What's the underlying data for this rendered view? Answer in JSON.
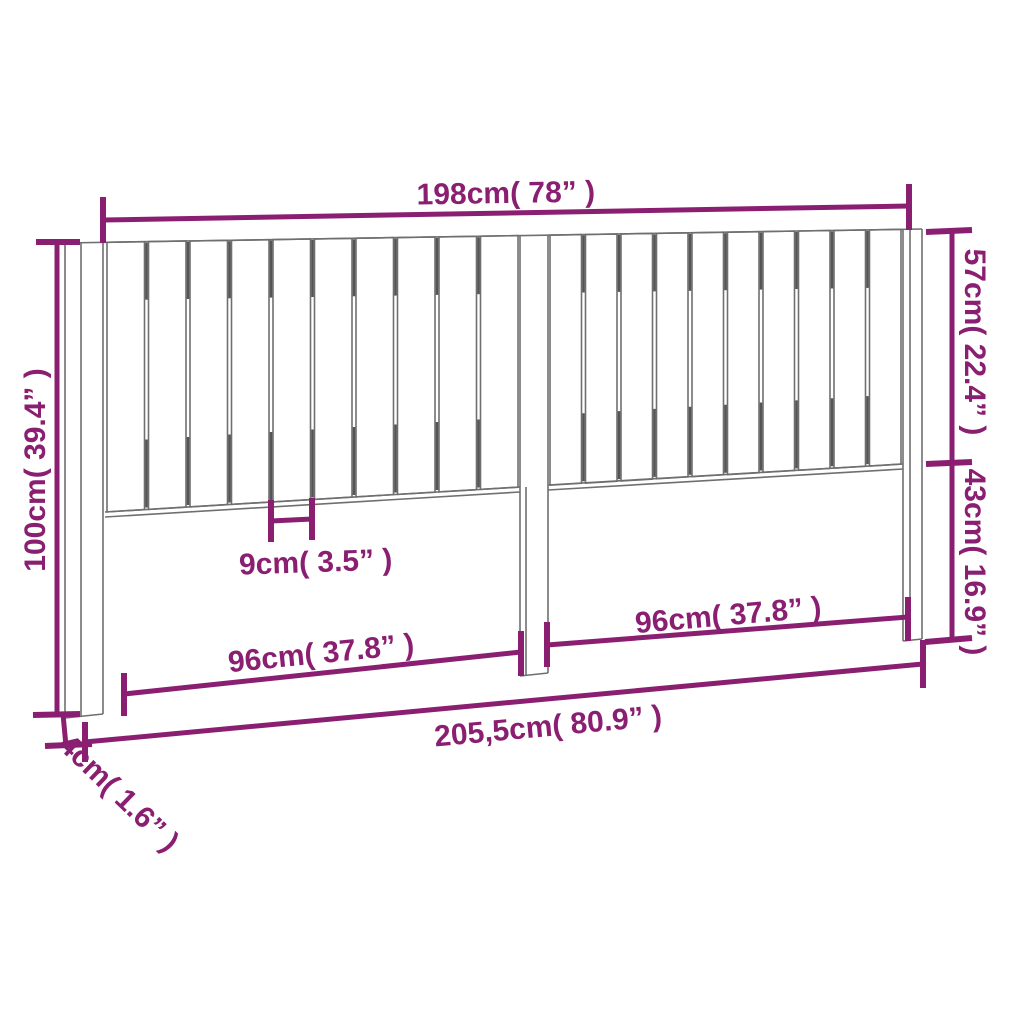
{
  "diagram": {
    "type": "technical-dimension-drawing",
    "subject": "bed-headboard-with-vertical-slats",
    "background_color": "#ffffff",
    "outline_color": "#6f6f6f",
    "shading_color": "#555555",
    "dimension_color": "#8a1f72",
    "slat_count_left": 10,
    "slat_count_right": 10,
    "dimensions": {
      "width_top": "198cm( 78” )",
      "slat_height_right": "57cm( 22.4” )",
      "leg_height_right": "43cm( 16.9” )",
      "total_height_left": "100cm( 39.4” )",
      "slat_width": "9cm( 3.5” )",
      "half_width_left": "96cm( 37.8” )",
      "half_width_right": "96cm( 37.8” )",
      "total_width_bottom": "205,5cm( 80.9” )",
      "board_thickness": "4cm( 1.6” )"
    }
  }
}
